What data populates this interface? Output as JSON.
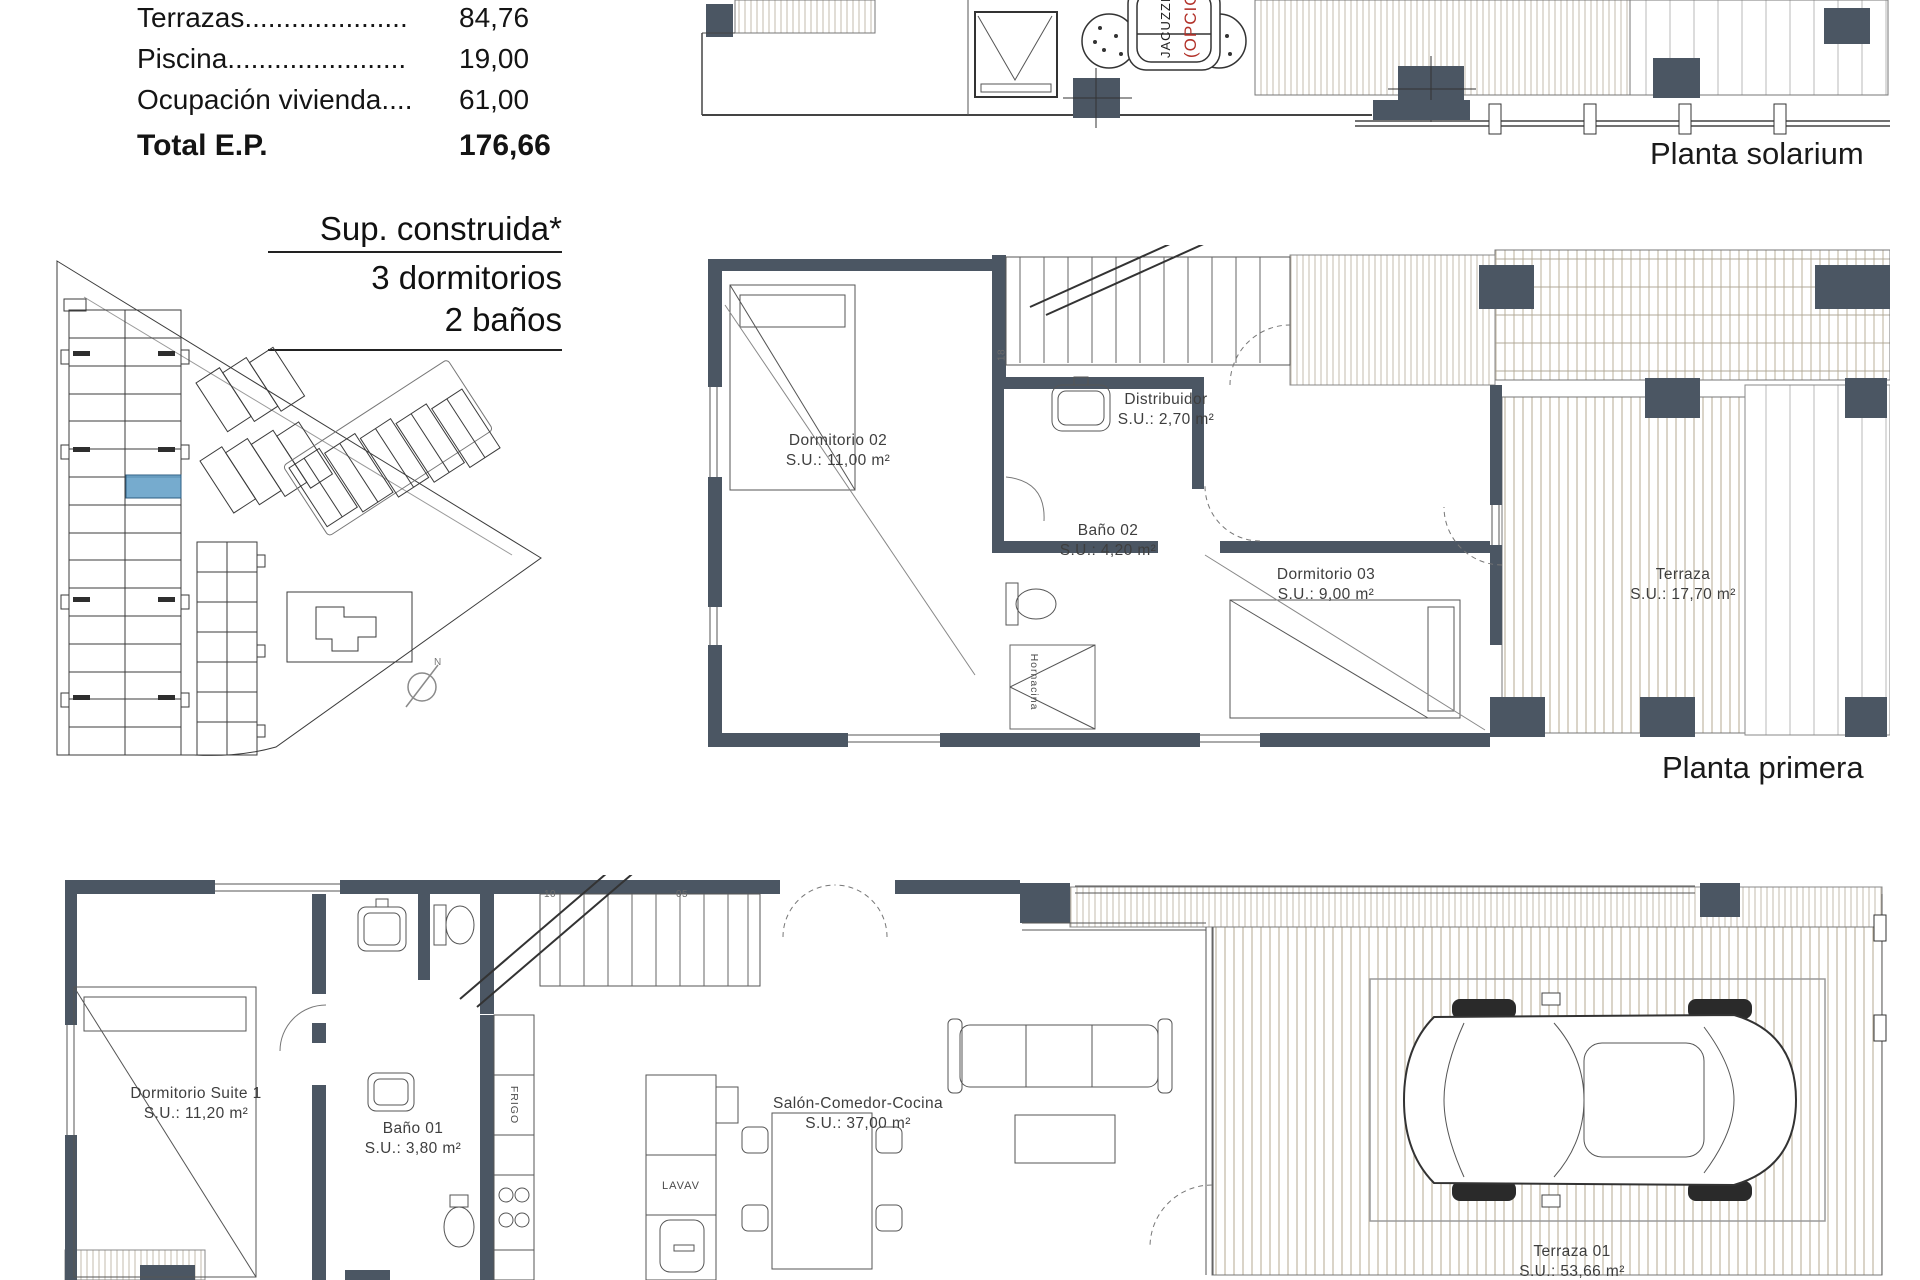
{
  "colors": {
    "wall": "#4b5663",
    "line": "#3c3c3c",
    "deck": "#c6bdab",
    "highlight": "#5e9cc6",
    "red": "#b23129"
  },
  "area_table": {
    "rows": [
      {
        "label": "Terrazas.....................",
        "value": "84,76"
      },
      {
        "label": "Piscina.......................",
        "value": "19,00"
      },
      {
        "label": "Ocupación vivienda....",
        "value": "61,00"
      }
    ],
    "total": {
      "label": "Total E.P.",
      "value": "176,66"
    }
  },
  "specs": {
    "line1": "Sup. construida*",
    "line2": "3 dormitorios",
    "line3": "2 baños"
  },
  "site_plan": {
    "north": "N"
  },
  "solarium": {
    "title": "Planta solarium",
    "jacuzzi": "JACUZZI",
    "optional": "(OPCIONAL)"
  },
  "primera": {
    "title": "Planta primera",
    "rooms": [
      {
        "name": "Dormitorio 02",
        "area": "S.U.: 11,00 m²"
      },
      {
        "name": "Distribuidor",
        "area": "S.U.: 2,70 m²"
      },
      {
        "name": "Baño 02",
        "area": "S.U.: 4,20 m²"
      },
      {
        "name": "Dormitorio 03",
        "area": "S.U.: 9,00 m²"
      },
      {
        "name": "Terraza",
        "area": "S.U.: 17,70 m²"
      }
    ],
    "niche": "Hornacina",
    "stair_dim": "18"
  },
  "baja": {
    "rooms": [
      {
        "name": "Dormitorio Suite 1",
        "area": "S.U.: 11,20 m²"
      },
      {
        "name": "Baño 01",
        "area": "S.U.: 3,80 m²"
      },
      {
        "name": "Salón-Comedor-Cocina",
        "area": "S.U.: 37,00 m²"
      },
      {
        "name": "Terraza 01",
        "area": "S.U.: 53,66 m²"
      }
    ],
    "fridge": "FRIGO",
    "dishwasher": "LAVAV",
    "stair_dims": [
      "10",
      "05"
    ]
  }
}
